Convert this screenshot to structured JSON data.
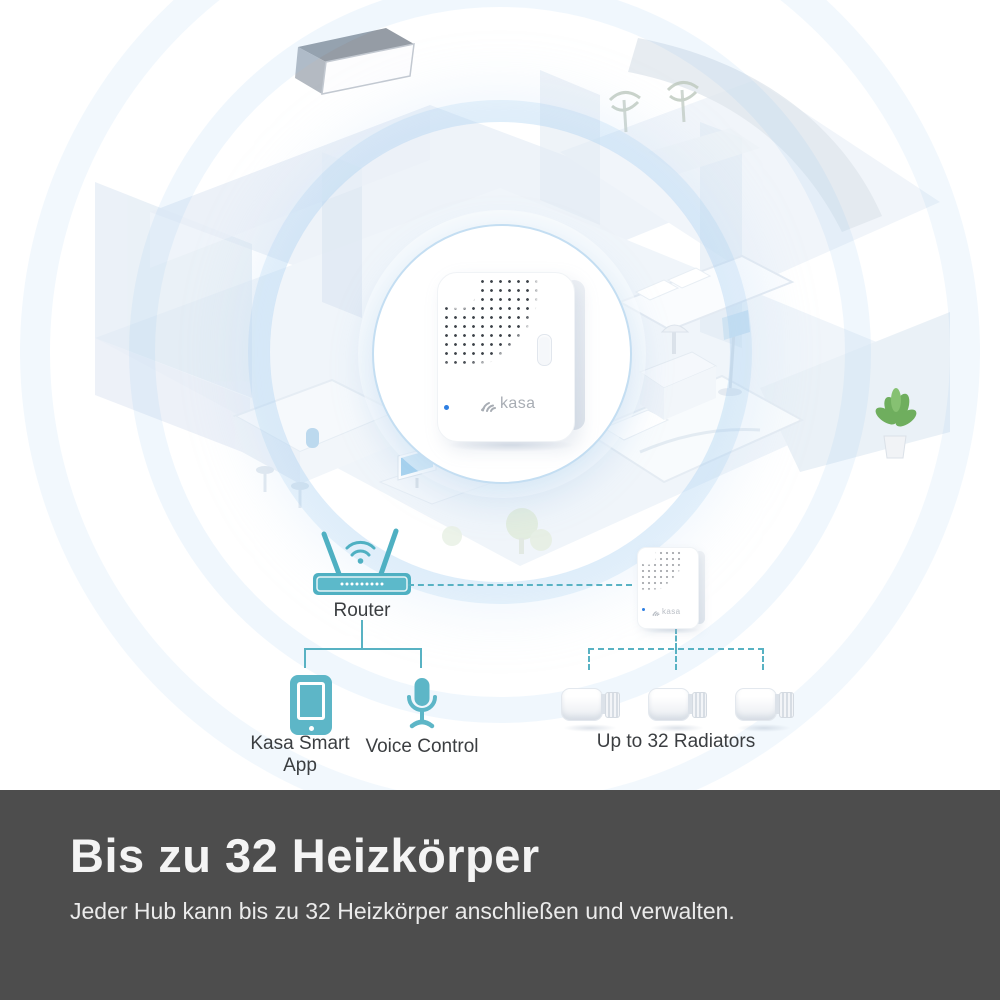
{
  "hub": {
    "brand": "kasa"
  },
  "connections": {
    "router_label": "Router",
    "app_label": "Kasa Smart App",
    "voice_label": "Voice Control",
    "radiators_label": "Up to 32 Radiators"
  },
  "banner": {
    "title": "Bis zu 32 Heizkörper",
    "subtitle": "Jeder Hub kann bis zu 32 Heizkörper anschließen und verwalten."
  },
  "colors": {
    "teal_accent": "#58b2c3",
    "banner_bg": "#4d4d4d",
    "led_blue": "#2e7fe2",
    "halo_blue": "#96c8f2",
    "plant_green": "#6fae5e"
  },
  "icons": {
    "router": "router-icon",
    "wifi": "wifi-icon",
    "smartphone": "smartphone-icon",
    "microphone": "microphone-icon",
    "radiator_valve": "radiator-valve-icon",
    "kasa_fan": "kasa-logo-icon",
    "speaker_grille": "speaker-grille-pattern"
  }
}
